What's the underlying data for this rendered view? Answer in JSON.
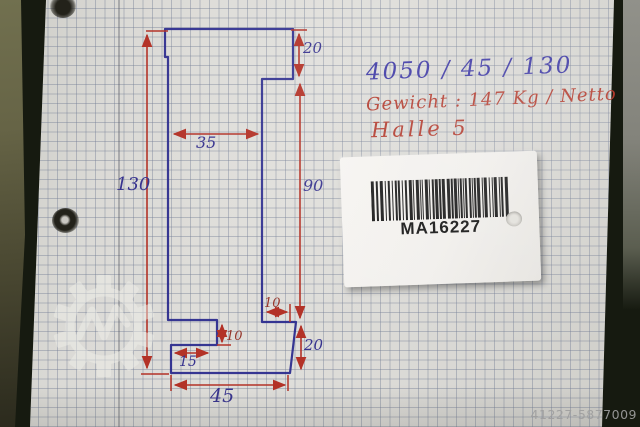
{
  "photo": {
    "notes": {
      "line1": "4050 / 45 / 130",
      "line2": "Gewicht : 147 Kg / Netto",
      "line3": "Halle 5"
    },
    "sketch": {
      "dim_total_height": "130",
      "dim_column_width": "35",
      "dim_top_right_height": "20",
      "dim_right_height": "90",
      "dim_step_width": "10",
      "dim_notch_height": "10",
      "dim_notch_width": "15",
      "dim_bottom_right_height": "20",
      "dim_bottom_width": "45"
    },
    "label": {
      "barcode_text": "MA16227"
    },
    "watermark_id": "41227-5877009",
    "colors": {
      "ink_blue": "#2c2c8e",
      "ink_red": "#b33227",
      "paper": "#d9d8d4"
    }
  }
}
